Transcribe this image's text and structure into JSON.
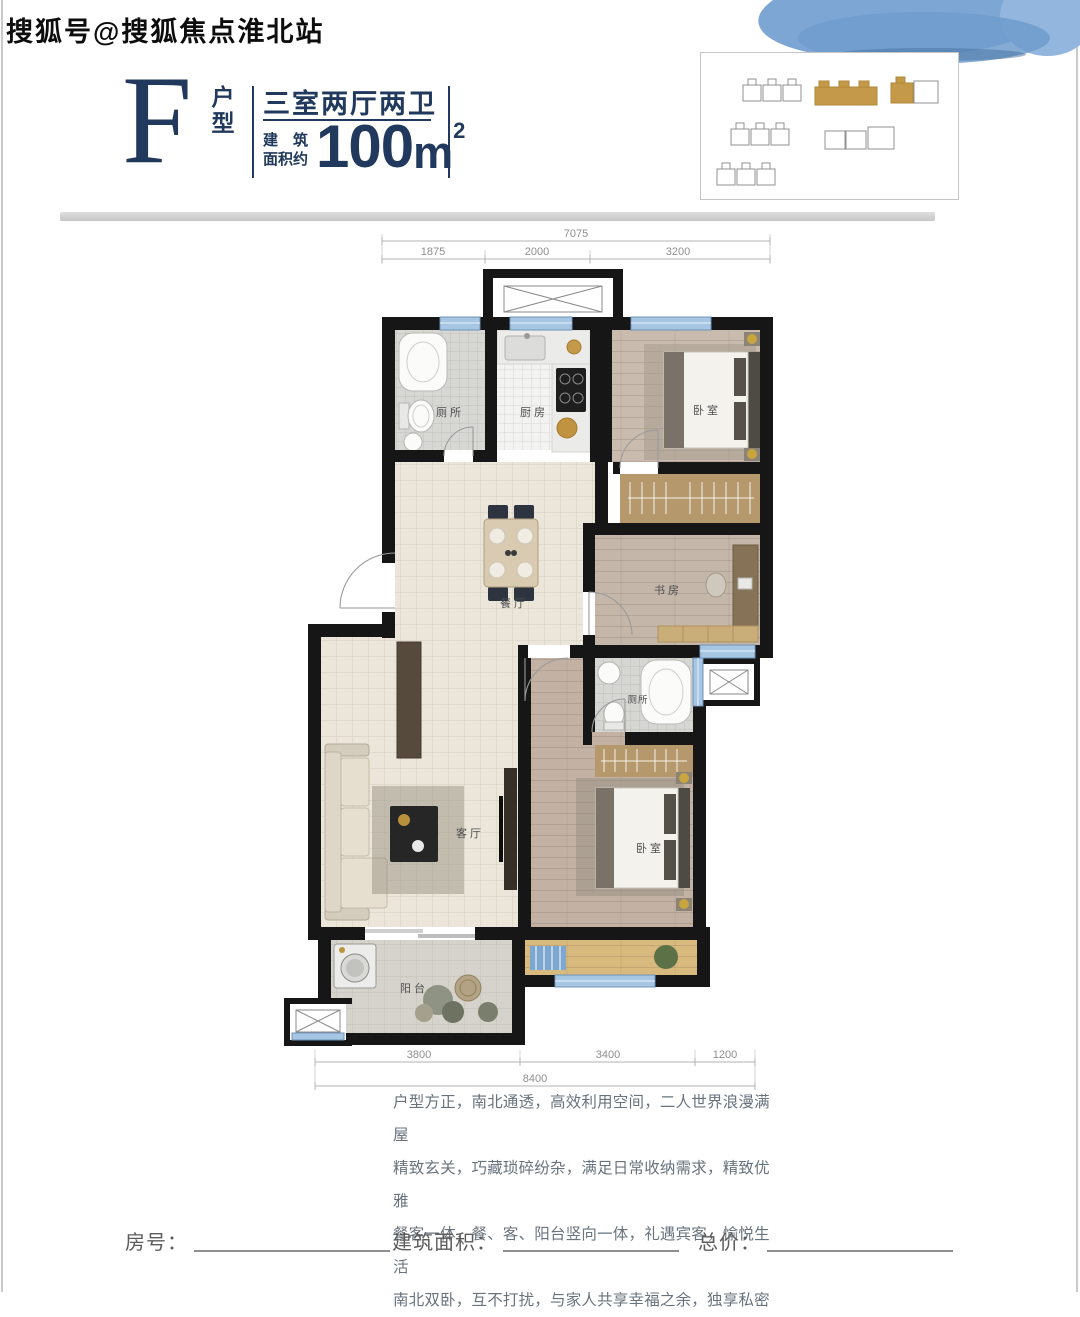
{
  "watermark": "搜狐号@搜狐焦点淮北站",
  "header": {
    "type_letter": "F",
    "type_letter_label": "户型",
    "layout_title": "三室两厅两卫",
    "area_label_line1": "建　筑",
    "area_label_line2": "面积约",
    "area_value": "100",
    "area_unit": "m",
    "area_superscript": "2"
  },
  "floor_plan": {
    "rooms": {
      "toilet_top": "厕所",
      "kitchen": "厨房",
      "bedroom_top": "卧室",
      "study": "书房",
      "dining": "餐厅",
      "living": "客厅",
      "toilet_bottom": "厕所",
      "bedroom_bottom": "卧室",
      "balcony": "阳台"
    },
    "dimensions_top": {
      "total": "7075",
      "segments": [
        "1875",
        "2000",
        "3200"
      ]
    },
    "dimensions_bottom": {
      "segments": [
        "3800",
        "3400",
        "1200"
      ],
      "total": "8400"
    }
  },
  "description": {
    "lines": [
      "户型方正，南北通透，高效利用空间，二人世界浪漫满屋",
      "精致玄关，巧藏琐碎纷杂，满足日常收纳需求，精致优雅",
      "餐客一体，餐、客、阳台竖向一体，礼遇宾客，愉悦生活",
      "南北双卧，互不打扰，与家人共享幸福之余，独享私密"
    ]
  },
  "footer": {
    "fields": [
      {
        "label": "房号："
      },
      {
        "label": "建筑面积："
      },
      {
        "label": "总价："
      }
    ]
  },
  "colors": {
    "accent_navy": "#20395c",
    "site_highlight_gold": "#c49a4a",
    "wall_black": "#161616",
    "window_blue": "#a6c6e4"
  }
}
